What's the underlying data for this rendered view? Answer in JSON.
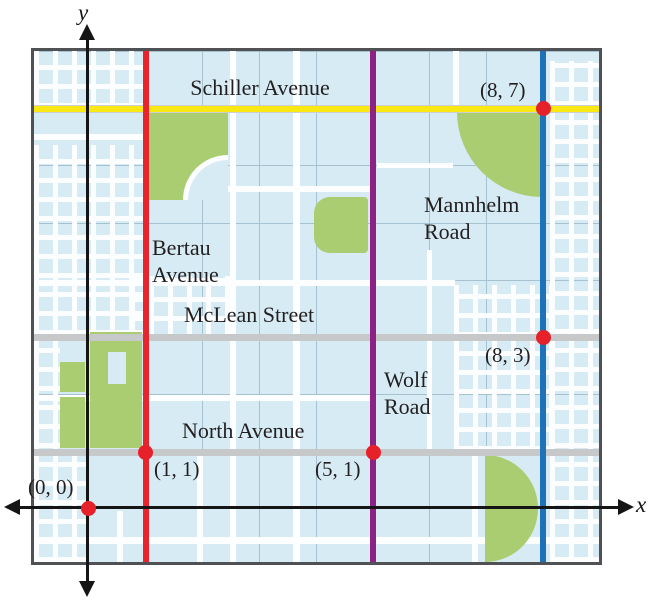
{
  "axes": {
    "x_label": "x",
    "y_label": "y"
  },
  "map": {
    "streets": [
      {
        "name": "Schiller Avenue",
        "orientation": "horizontal",
        "coordinate": 7,
        "color": "#f9e814"
      },
      {
        "name": "Bertau Avenue",
        "orientation": "vertical",
        "coordinate": 1,
        "color": "#e8242c"
      },
      {
        "name": "McLean Street",
        "orientation": "horizontal",
        "coordinate": 3,
        "color": "#c6c8ca"
      },
      {
        "name": "North Avenue",
        "orientation": "horizontal",
        "coordinate": 1,
        "color": "#c6c8ca"
      },
      {
        "name": "Wolf Road",
        "orientation": "vertical",
        "coordinate": 5,
        "color": "#8e2184"
      },
      {
        "name": "Mannhelm Road",
        "orientation": "vertical",
        "coordinate": 8,
        "color": "#1e72b8"
      }
    ],
    "points": [
      {
        "label": "(0, 0)",
        "x": 0,
        "y": 0
      },
      {
        "label": "(1, 1)",
        "x": 1,
        "y": 1
      },
      {
        "label": "(5, 1)",
        "x": 5,
        "y": 1
      },
      {
        "label": "(8, 3)",
        "x": 8,
        "y": 3
      },
      {
        "label": "(8, 7)",
        "x": 8,
        "y": 7
      }
    ],
    "colors": {
      "map_background": "#d6ebf4",
      "park_green": "#aacd72",
      "grid_line": "#a6c2d0",
      "minor_street": "#ffffff",
      "point_dot": "#e62129",
      "border": "#4f5154",
      "axis": "#151515"
    }
  }
}
